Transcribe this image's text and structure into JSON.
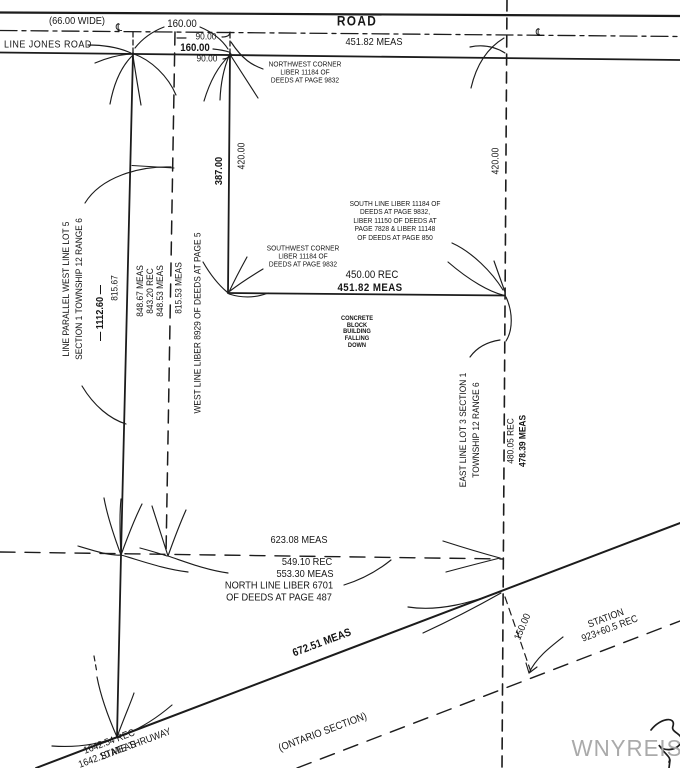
{
  "road": {
    "title": "ROAD",
    "width_note": "(66.00 WIDE)",
    "meas": "451.82  MEAS",
    "jones_label": "LINE JONES ROAD",
    "frontage_total_top": "160.00",
    "segment_90_top": "90.00",
    "frontage_bold": "160.00",
    "segment_90_bottom": "90.00",
    "centerline_symbol": "℄"
  },
  "west": {
    "parallel_line_note": [
      "LINE PARALLEL WEST LINE LOT 5",
      "SECTION 1 TOWNSHIP 12 RANGE 6"
    ],
    "dist_1112": "— 1112.60 —",
    "dist_815_67": "815.67",
    "meas_stack": [
      "848.67 MEAS",
      "843.20 REC",
      "848.53 MEAS"
    ],
    "meas_815_53": "815.53 MEAS",
    "west_line_label": "WEST LINE LIBER 8929 OF DEEDS AT PAGE 5"
  },
  "parcel": {
    "nw_corner_note": [
      "NORTHWEST CORNER",
      "LIBER 11184 OF",
      "DEEDS AT PAGE 9832"
    ],
    "west_dim_387": "387.00",
    "west_dim_420": "420.00",
    "east_dim_420": "420.00",
    "south_line_note": [
      "SOUTH LINE LIBER 11184 OF",
      "DEEDS AT PAGE 9832,",
      "LIBER 11150 OF DEEDS AT",
      "PAGE 7828 & LIBER 11148",
      "OF DEEDS AT PAGE 850"
    ],
    "sw_corner_note": [
      "SOUTHWEST CORNER",
      "LIBER 11184 OF",
      "DEEDS AT PAGE 9832"
    ],
    "south_rec": "450.00 REC",
    "south_meas": "451.82  MEAS",
    "building_note": [
      "CONCRETE",
      "BLOCK",
      "BUILDING",
      "FALLING",
      "DOWN"
    ]
  },
  "east": {
    "east_line_note": [
      "EAST LINE LOT 3 SECTION 1",
      "TOWNSHIP 12 RANGE 6"
    ],
    "rec_480": "480.05 REC",
    "meas_478": "478.39 MEAS"
  },
  "south": {
    "meas_623": "623.08 MEAS",
    "rec_549": "549.10 REC",
    "meas_553": "553.30 MEAS",
    "north_line_note": [
      "NORTH LINE LIBER 6701",
      "OF DEEDS AT PAGE 487"
    ],
    "meas_672": "672.51 MEAS"
  },
  "thruway": {
    "rec_1642": "1642.54 REC",
    "meas_1642": "1642.10 MEAS",
    "name": "STATE  THRUWAY",
    "section": "(ONTARIO SECTION)",
    "station": "STATION 923+60.5 REC",
    "offset_150": "150.00"
  },
  "watermark": "WNYREIS",
  "colors": {
    "ink": "#1c1c1c",
    "watermark": "#aaaaaa"
  }
}
